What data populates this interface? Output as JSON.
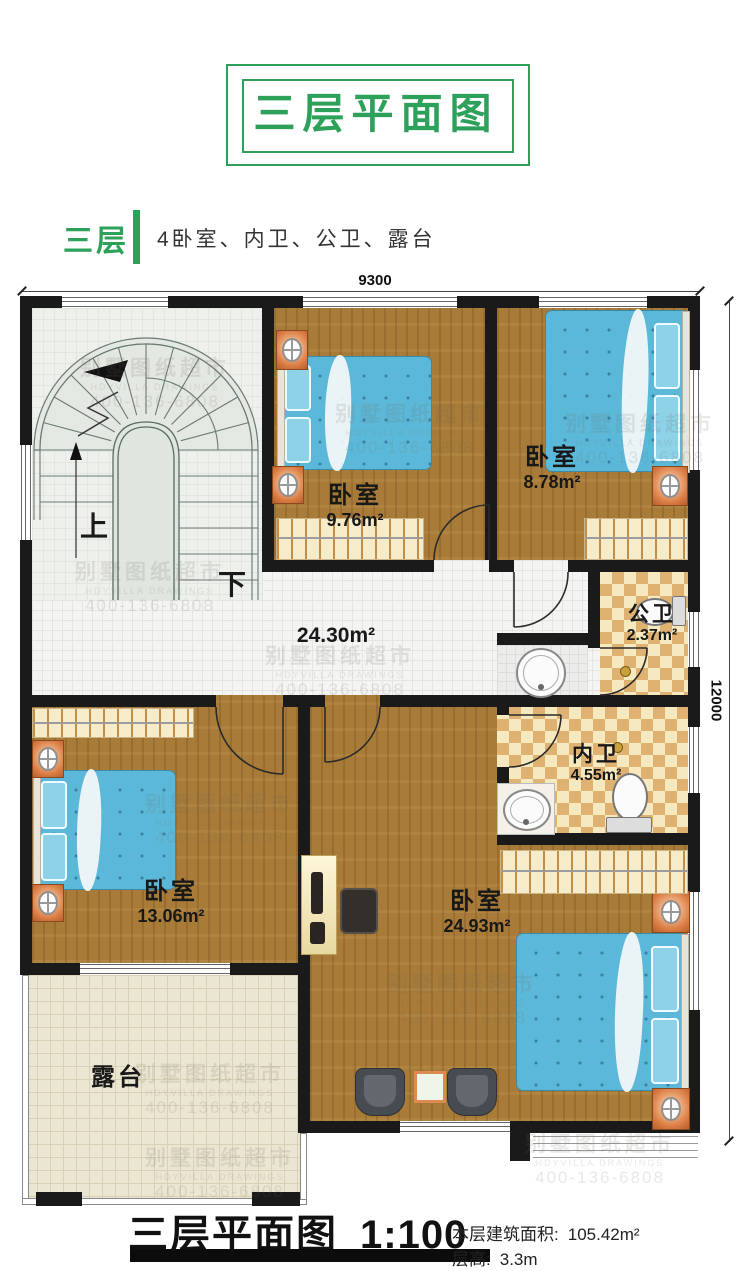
{
  "title": "三层平面图",
  "floor_tag": "三层",
  "floor_desc": "4卧室、内卫、公卫、露台",
  "dimensions": {
    "top": "9300",
    "right": "12000"
  },
  "stairs": {
    "up": "上",
    "down": "下"
  },
  "rooms": {
    "bedroom_top_mid": {
      "label": "卧室",
      "area": "9.76m²"
    },
    "bedroom_top_right": {
      "label": "卧室",
      "area": "8.78m²"
    },
    "public_bath": {
      "label": "公卫",
      "area": "2.37m²"
    },
    "inner_bath": {
      "label": "内卫",
      "area": "4.55m²"
    },
    "bedroom_left": {
      "label": "卧室",
      "area": "13.06m²"
    },
    "bedroom_master": {
      "label": "卧室",
      "area": "24.93m²"
    },
    "hallway": {
      "area": "24.30m²"
    },
    "terrace": {
      "label": "露台"
    }
  },
  "footer": {
    "plan_title": "三层平面图",
    "scale": "1:100",
    "area_label": "本层建筑面积:",
    "area_value": "105.42m²",
    "floor_height_label": "层高:",
    "floor_height_value": "3.3m"
  },
  "watermark": {
    "line1": "别墅图纸超市",
    "line2": "HDYVILLA DRAWINGS",
    "line3": "400-136-6808"
  },
  "colors": {
    "accent_green": "#2da05a",
    "wall": "#1a1a1a",
    "wood": "#a87b38",
    "bed_blue": "#5cb8d8",
    "tile_dark": "#dfb271",
    "tile_light": "#f6e9c0",
    "terrace": "#ebe6d2"
  }
}
